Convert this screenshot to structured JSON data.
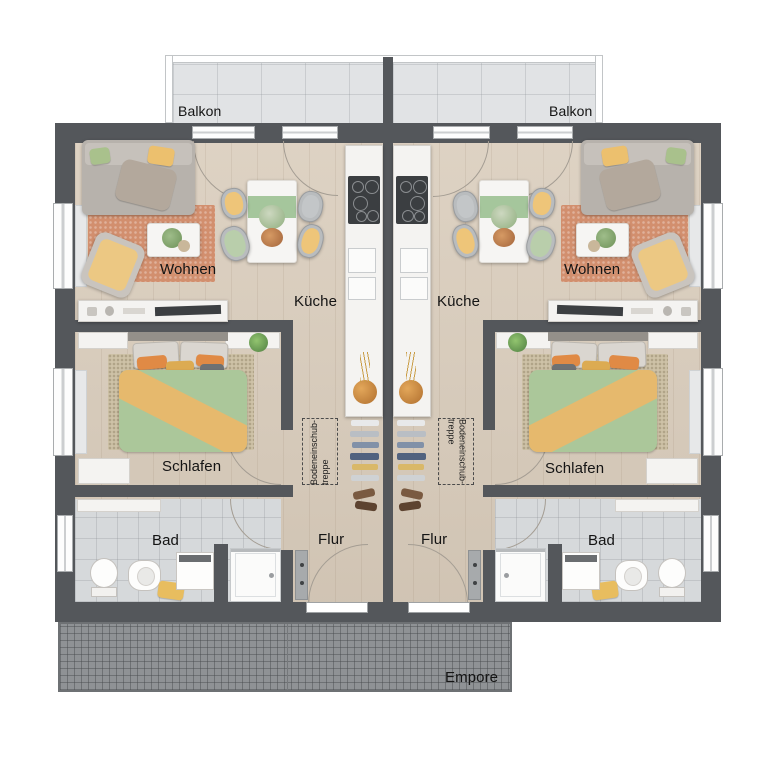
{
  "floorplan": {
    "type": "residential-duplex-upper-floor-plan",
    "labels": {
      "balkon_left": "Balkon",
      "balkon_right": "Balkon",
      "wohnen_left": "Wohnen",
      "wohnen_right": "Wohnen",
      "kueche_left": "Küche",
      "kueche_right": "Küche",
      "schlafen_left": "Schlafen",
      "schlafen_right": "Schlafen",
      "bad_left": "Bad",
      "bad_right": "Bad",
      "flur_left": "Flur",
      "flur_right": "Flur",
      "empore": "Empore",
      "attic_stairs_line1": "Bodeneinschub-",
      "attic_stairs_line2": "treppe"
    },
    "colors": {
      "wall": "#54575b",
      "wood_floor": "#d9ccbb",
      "bath_tile": "#d6d9db",
      "balcony_tile": "#e1e3e5",
      "empore_grid": "#8f9295",
      "rug_terracotta": "#d28f6e",
      "bed_rug": "#cec2a7",
      "duvet_green": "#abc79a",
      "blanket_yellow": "#e6b96d",
      "accent_yellow": "#ecc26f",
      "pillow_orange": "#e08a45",
      "runner_green": "#a5c69c",
      "label_text": "#141414"
    }
  }
}
